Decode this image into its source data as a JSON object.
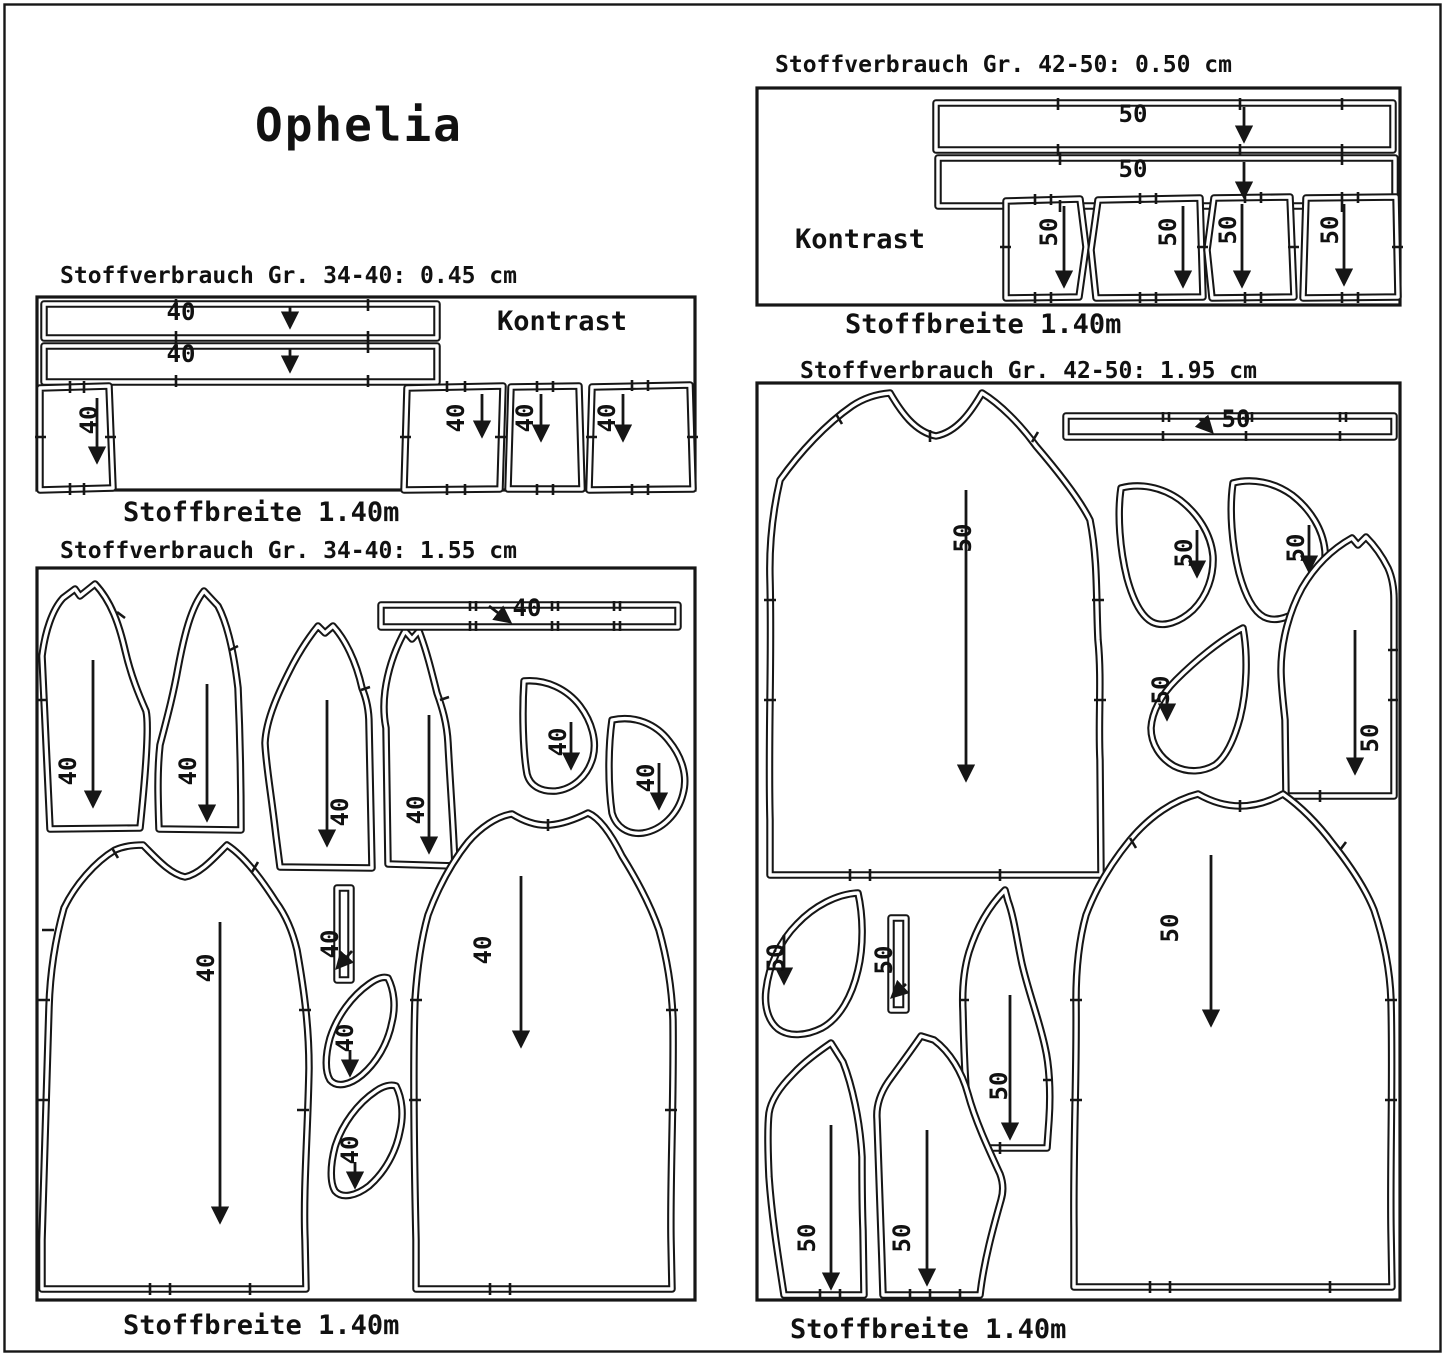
{
  "page": {
    "title": "Ophelia"
  },
  "panels": [
    {
      "name": "contrast-layout-34-40",
      "header": "Stoffverbrauch Gr. 34-40: 0.45 cm",
      "footer": "Stoffbreite 1.40m",
      "contrast_label": "Kontrast",
      "sizes": "34-40",
      "fabric_usage": "0.45 cm",
      "fabric_width": "1.40m",
      "pieces": [
        {
          "name": "binding-strip-1",
          "label": "40"
        },
        {
          "name": "binding-strip-2",
          "label": "40"
        },
        {
          "name": "contrast-piece-1",
          "label": "40"
        },
        {
          "name": "contrast-piece-2",
          "label": "40"
        },
        {
          "name": "contrast-piece-3",
          "label": "40"
        },
        {
          "name": "contrast-piece-4",
          "label": "40"
        }
      ]
    },
    {
      "name": "contrast-layout-42-50",
      "header": "Stoffverbrauch Gr. 42-50: 0.50 cm",
      "footer": "Stoffbreite 1.40m",
      "contrast_label": "Kontrast",
      "sizes": "42-50",
      "fabric_usage": "0.50 cm",
      "fabric_width": "1.40m",
      "pieces": [
        {
          "name": "binding-strip-1",
          "label": "50"
        },
        {
          "name": "binding-strip-2",
          "label": "50"
        },
        {
          "name": "contrast-piece-1",
          "label": "50"
        },
        {
          "name": "contrast-piece-2",
          "label": "50"
        },
        {
          "name": "contrast-piece-3",
          "label": "50"
        },
        {
          "name": "contrast-piece-4",
          "label": "50"
        }
      ]
    },
    {
      "name": "main-layout-34-40",
      "header": "Stoffverbrauch Gr. 34-40: 1.55 cm",
      "footer": "Stoffbreite 1.40m",
      "sizes": "34-40",
      "fabric_usage": "1.55 cm",
      "fabric_width": "1.40m",
      "pieces": [
        {
          "name": "back-bodice",
          "label": "40"
        },
        {
          "name": "front-bodice",
          "label": "40"
        },
        {
          "name": "side-panel-left",
          "label": "40"
        },
        {
          "name": "side-panel-right",
          "label": "40"
        },
        {
          "name": "neck-binding-strip",
          "label": "40"
        },
        {
          "name": "pocket-facing-1",
          "label": "40"
        },
        {
          "name": "pocket-facing-2",
          "label": "40"
        },
        {
          "name": "dress-panel-left",
          "label": "40"
        },
        {
          "name": "loop-strip",
          "label": "40"
        },
        {
          "name": "pocket-1",
          "label": "40"
        },
        {
          "name": "pocket-2",
          "label": "40"
        },
        {
          "name": "dress-panel-right",
          "label": "40"
        }
      ]
    },
    {
      "name": "main-layout-42-50",
      "header": "Stoffverbrauch Gr. 42-50: 1.95 cm",
      "footer": "Stoffbreite 1.40m",
      "sizes": "42-50",
      "fabric_usage": "1.95 cm",
      "fabric_width": "1.40m",
      "pieces": [
        {
          "name": "dress-panel-back",
          "label": "50"
        },
        {
          "name": "neck-binding-strip",
          "label": "50"
        },
        {
          "name": "pocket-facing-1",
          "label": "50"
        },
        {
          "name": "pocket-facing-2",
          "label": "50"
        },
        {
          "name": "pocket-facing-3",
          "label": "50"
        },
        {
          "name": "sleeve-side",
          "label": "50"
        },
        {
          "name": "dress-panel-front",
          "label": "50"
        },
        {
          "name": "pocket-piece",
          "label": "50"
        },
        {
          "name": "loop-strip",
          "label": "50"
        },
        {
          "name": "sleeve-center",
          "label": "50"
        },
        {
          "name": "bodice-left",
          "label": "50"
        },
        {
          "name": "bodice-center",
          "label": "50"
        }
      ]
    }
  ]
}
